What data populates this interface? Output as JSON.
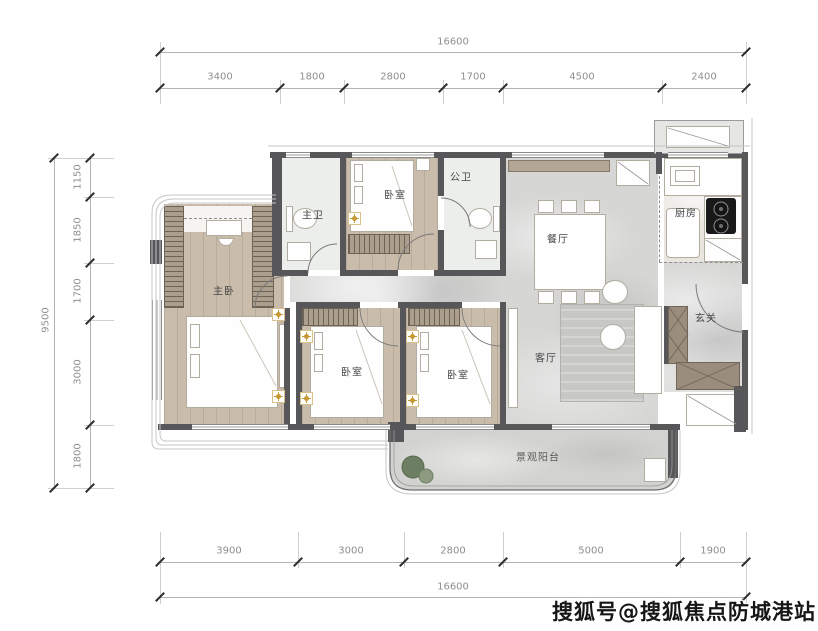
{
  "watermark": {
    "text": "搜狐号@搜狐焦点防城港站"
  },
  "dimensions": {
    "top": {
      "total": "16600",
      "segments": [
        "3400",
        "1800",
        "2800",
        "1700",
        "4500",
        "2400"
      ]
    },
    "left": {
      "total": "9500",
      "segments": [
        "1150",
        "1850",
        "1700",
        "3000",
        "1800"
      ]
    },
    "bottom": {
      "total": "16600",
      "segments": [
        "3900",
        "3000",
        "2800",
        "5000",
        "1900"
      ]
    }
  },
  "rooms": {
    "master_bedroom": "主卧",
    "master_bath": "主卫",
    "bedroom_top": "卧室",
    "public_bath": "公卫",
    "dining": "餐厅",
    "kitchen": "厨房",
    "foyer": "玄关",
    "living": "客厅",
    "bedroom_left": "卧室",
    "bedroom_right": "卧室",
    "balcony": "景观阳台"
  },
  "colors": {
    "wall": "#57575a",
    "wood_floor": "#c9bcab",
    "marble_floor": "#d6d6d5",
    "cabinet_brown": "#9b8d7c",
    "accent_gold": "#c59a35",
    "dimension_text": "#8f8f8f"
  }
}
